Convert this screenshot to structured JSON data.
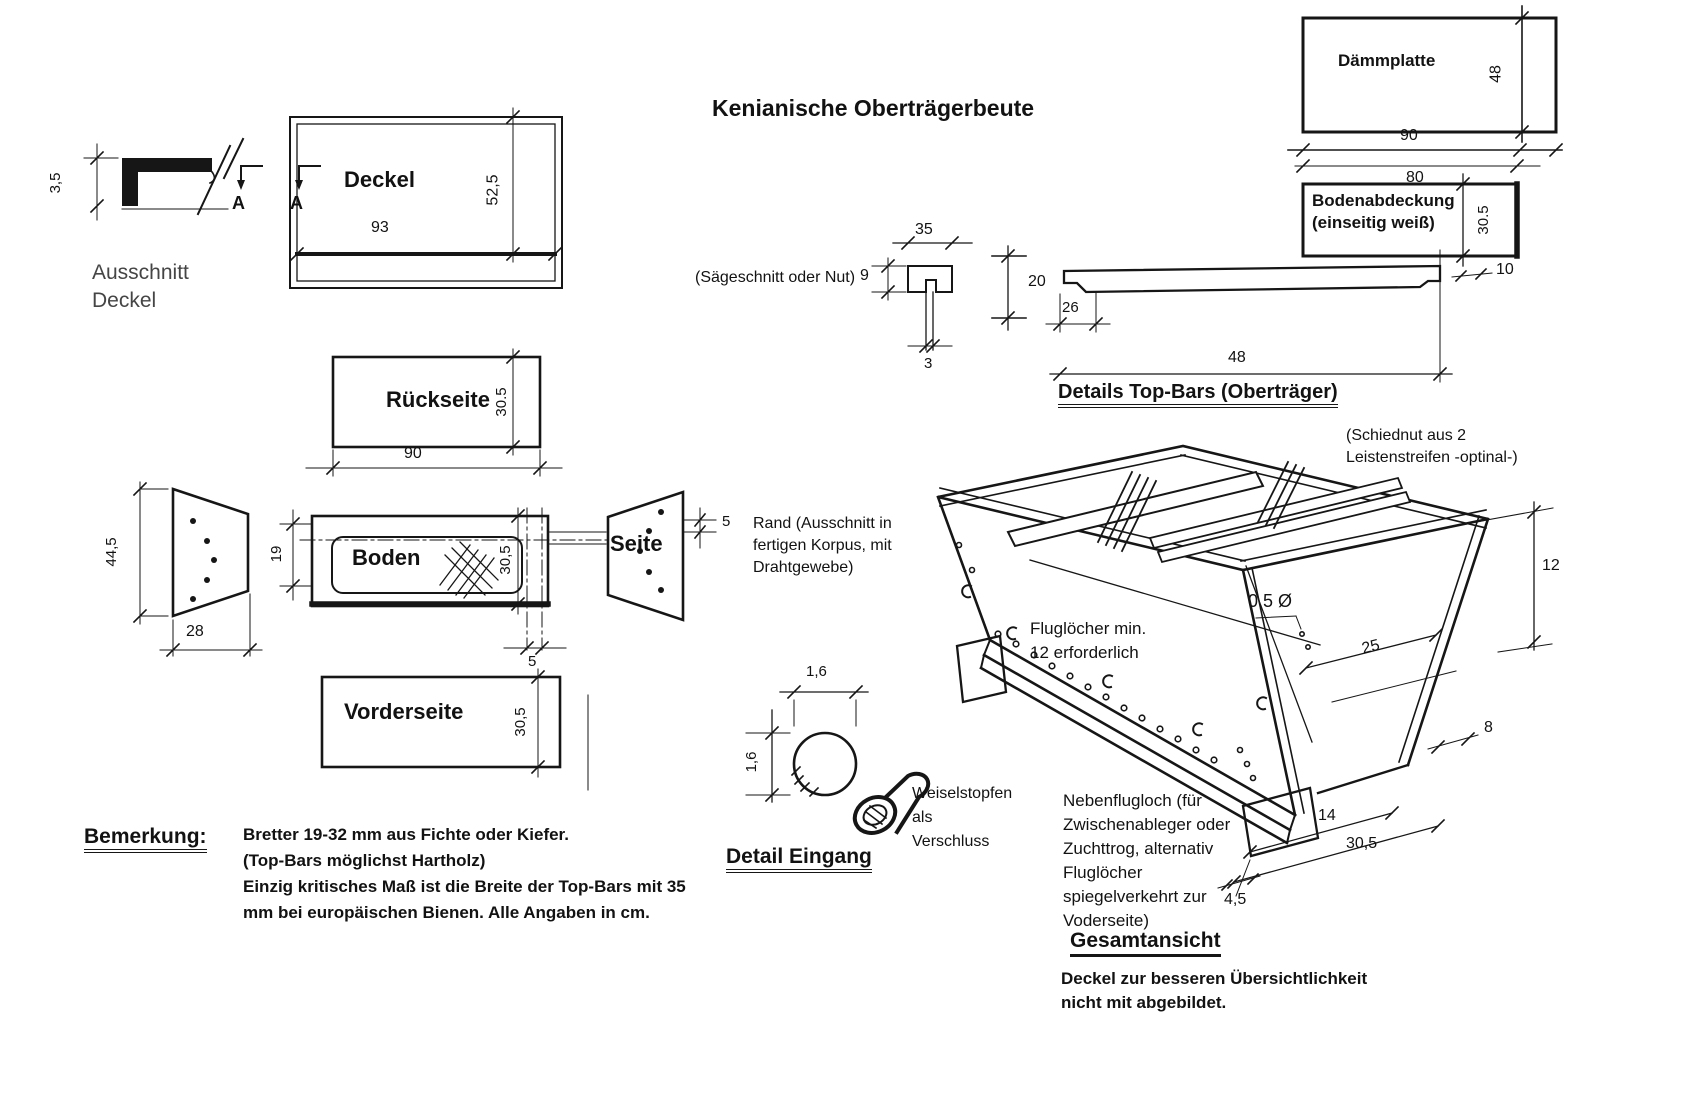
{
  "title": "Kenianische Oberträgerbeute",
  "cover_detail": {
    "dim_thickness": "3,5",
    "caption_line1": "Ausschnitt",
    "caption_line2": "Deckel"
  },
  "cover": {
    "label": "Deckel",
    "dim_length": "93",
    "dim_width": "52,5",
    "section_marker": "A"
  },
  "back_panel": {
    "label": "Rückseite",
    "dim_height": "30.5",
    "dim_length": "90"
  },
  "side_blank": {
    "dim_height": "44,5",
    "dim_bottom_width": "28"
  },
  "bottom_panel": {
    "label": "Boden",
    "dim_slot_width": "19",
    "dim_height": "30,5",
    "dim_rim": "5"
  },
  "side_panel": {
    "label": "Seite",
    "dim_rim": "5"
  },
  "rim_note": {
    "line1": "Rand (Ausschnitt in",
    "line2": "fertigen Korpus, mit",
    "line3": "Drahtgewebe)"
  },
  "front_panel": {
    "label": "Vorderseite",
    "dim_height": "30,5"
  },
  "remark": {
    "heading": "Bemerkung:",
    "line1": "Bretter 19-32 mm aus Fichte oder Kiefer.",
    "line2": "(Top-Bars möglichst Hartholz)",
    "line3": "Einzig kritisches Maß ist die Breite der Top-Bars mit 35",
    "line4": "mm bei europäischen Bienen. Alle Angaben in cm."
  },
  "insulation_board": {
    "label": "Dämmplatte",
    "dim_width": "48",
    "dim_length_outer": "90",
    "dim_length_inner": "80"
  },
  "floor_cover": {
    "label_line1": "Bodenabdeckung",
    "label_line2": "(einseitig weiß)",
    "dim_height": "30.5"
  },
  "top_bar": {
    "heading": "Details Top-Bars (Oberträger)",
    "saw_note": "(Sägeschnitt oder Nut)",
    "dim_thickness": "9",
    "dim_width": "35",
    "dim_kerf": "3",
    "dim_height": "20",
    "dim_end": "26",
    "dim_length": "48",
    "dim_tab": "10"
  },
  "overview": {
    "heading": "Gesamtansicht",
    "slide_note_line1": "(Schiednut aus 2",
    "slide_note_line2": "Leistenstreifen -optinal-)",
    "holes_note_line1": "Fluglöcher min.",
    "holes_note_line2": "12 erforderlich",
    "dim_depth": "12",
    "dim_hole": "0,5 Ø",
    "dim_spacing": "25",
    "dim_8": "8",
    "dim_14": "14",
    "dim_length": "30,5",
    "dim_45": "4,5",
    "side_note_line1": "Nebenflugloch (für",
    "side_note_line2": "Zwischenableger oder",
    "side_note_line3": "Zuchttrog, alternativ",
    "side_note_line4": "Fluglöcher",
    "side_note_line5": "spiegelverkehrt zur",
    "side_note_line6": "Voderseite)",
    "footer_line1": "Deckel zur besseren Übersichtlichkeit",
    "footer_line2": "nicht mit abgebildet."
  },
  "entrance_detail": {
    "heading": "Detail Eingang",
    "dim_width": "1,6",
    "dim_height": "1,6",
    "plug_line1": "Weiselstopfen",
    "plug_line2": "als",
    "plug_line3": "Verschluss"
  }
}
